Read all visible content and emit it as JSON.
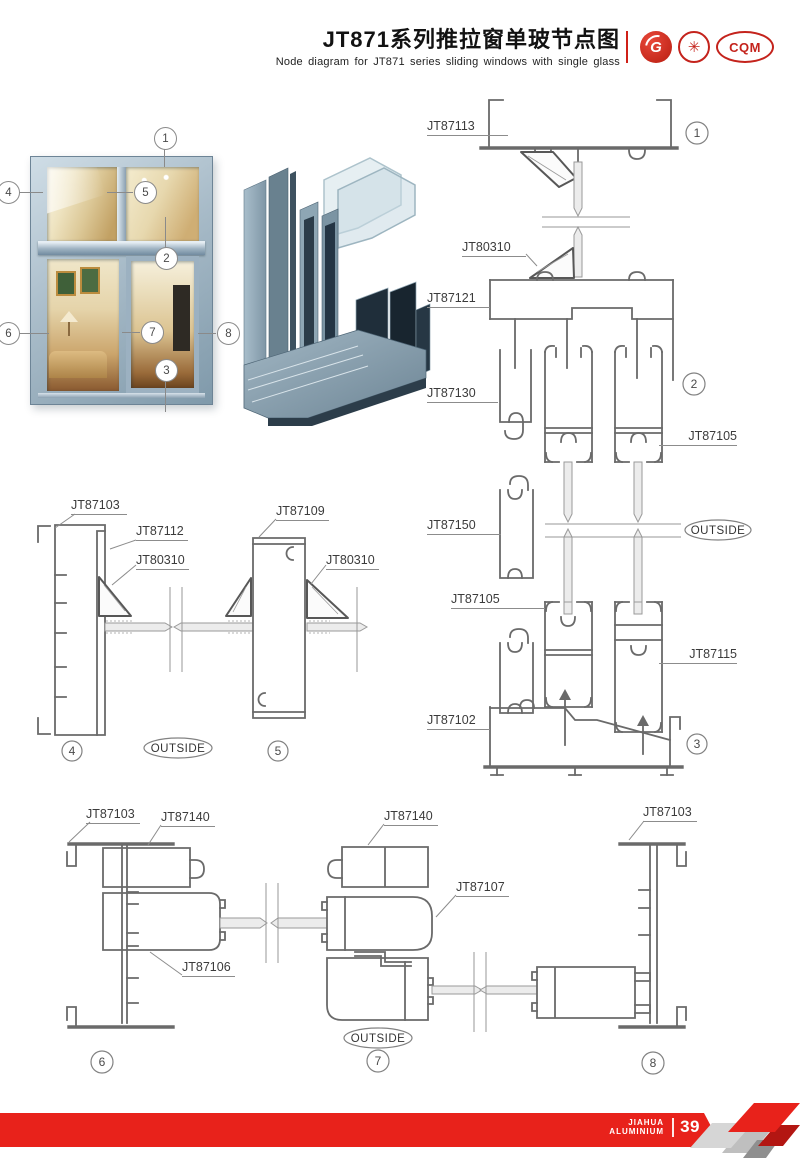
{
  "header": {
    "title": "JT871系列推拉窗单玻节点图",
    "subtitle": "Node diagram for JT871 series sliding windows with single glass",
    "logo_g": "G",
    "logo_emblem": "✳",
    "logo_cqm": "CQM"
  },
  "photo": {
    "callouts": {
      "n1": "1",
      "n2": "2",
      "n3": "3",
      "n4": "4",
      "n5": "5",
      "n6": "6",
      "n7": "7",
      "n8": "8"
    }
  },
  "sections": {
    "right": {
      "jt87113": "JT87113",
      "jt80310": "JT80310",
      "jt87121": "JT87121",
      "jt87130": "JT87130",
      "jt87105a": "JT87105",
      "jt87150": "JT87150",
      "jt87105b": "JT87105",
      "jt87115": "JT87115",
      "jt87102": "JT87102",
      "outside": "OUTSIDE",
      "c1": "1",
      "c2": "2",
      "c3": "3"
    },
    "mid": {
      "jt87103": "JT87103",
      "jt87112": "JT87112",
      "jt80310a": "JT80310",
      "jt87109": "JT87109",
      "jt80310b": "JT80310",
      "outside": "OUTSIDE",
      "c4": "4",
      "c5": "5"
    },
    "bottom": {
      "jt87103a": "JT87103",
      "jt87140a": "JT87140",
      "jt87106": "JT87106",
      "jt87140b": "JT87140",
      "jt87107": "JT87107",
      "jt87103b": "JT87103",
      "outside": "OUTSIDE",
      "c6": "6",
      "c7": "7",
      "c8": "8"
    }
  },
  "footer": {
    "brand_line1": "JIAHUA",
    "brand_line2": "ALUMINIUM",
    "page_number": "39"
  },
  "colors": {
    "accent_red": "#e8221b",
    "line_gray": "#6a6a6a",
    "frame_blue": "#9db3c2"
  }
}
